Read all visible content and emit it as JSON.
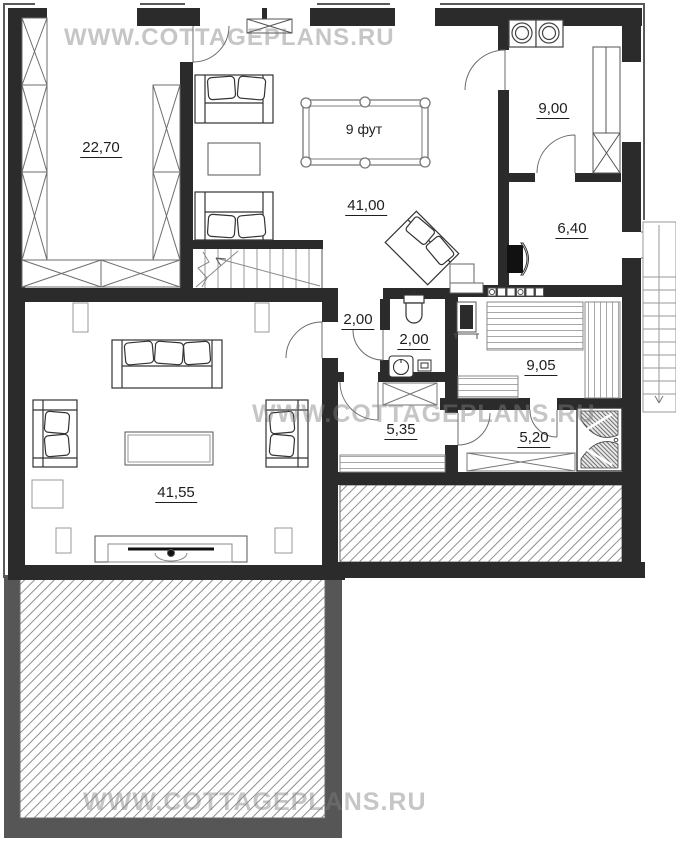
{
  "plan_title": "Cottage floor plan",
  "watermarks": [
    {
      "text": "WWW.COTTAGEPLANS.RU"
    },
    {
      "text": "WWW.COTTAGEPLANS.RU"
    },
    {
      "text": "WWW.COTTAGEPLANS.RU"
    }
  ],
  "rooms": [
    {
      "name": "wardrobe-room",
      "area": "22,70"
    },
    {
      "name": "billiard-hall",
      "area": "41,00"
    },
    {
      "name": "laundry-room",
      "area": "9,00"
    },
    {
      "name": "furnace-room",
      "area": "6,40"
    },
    {
      "name": "hallway",
      "area": "2,00"
    },
    {
      "name": "wc",
      "area": "2,00"
    },
    {
      "name": "sauna",
      "area": "9,05"
    },
    {
      "name": "changing-room",
      "area": "5,35"
    },
    {
      "name": "shower-room",
      "area": "5,20"
    },
    {
      "name": "living-room",
      "area": "41,55"
    }
  ],
  "furniture": {
    "billiard_table_label": "9 фут"
  },
  "colors": {
    "wall": "#2b2b2b",
    "terrace_frame": "#565656",
    "hatch_line": "#8f8f8f",
    "watermark": "#c7c7c7"
  }
}
